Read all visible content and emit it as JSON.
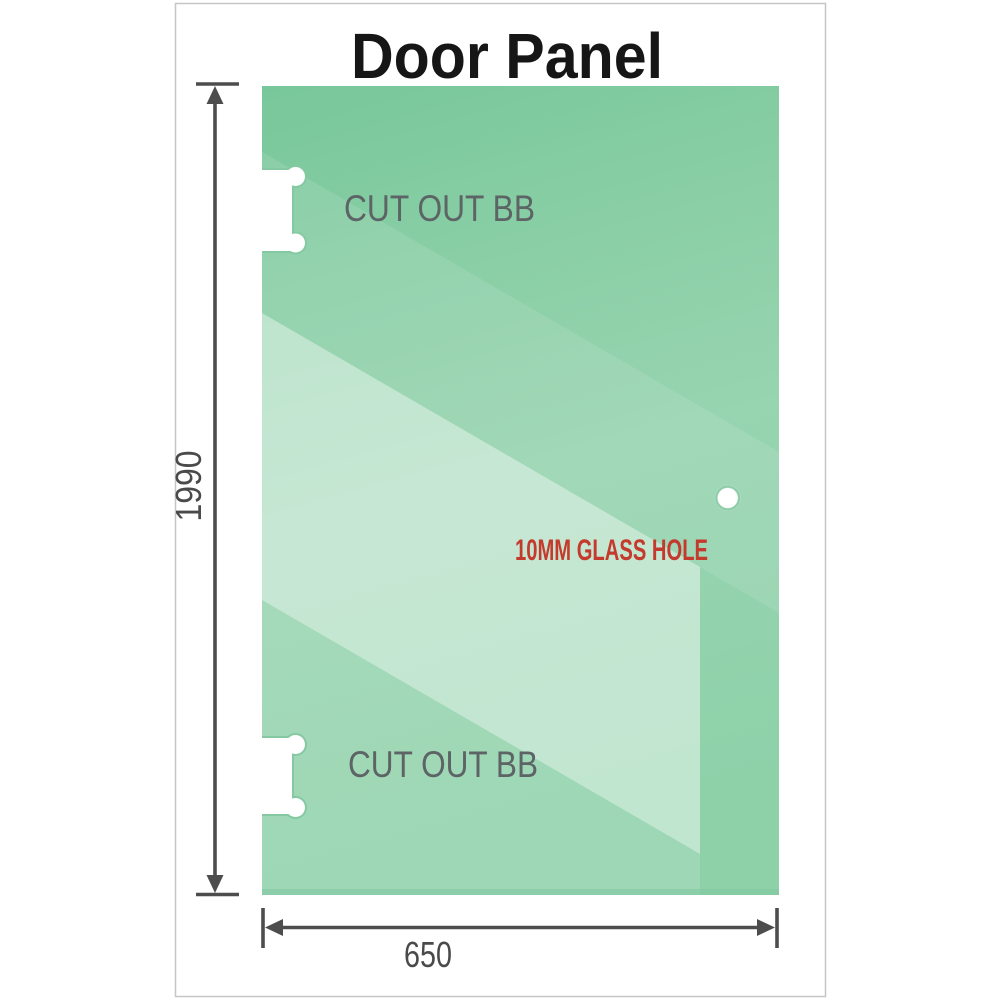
{
  "title": "Door Panel",
  "glass_panel": {
    "cutouts": [
      {
        "label": "CUT OUT BB"
      },
      {
        "label": "CUT OUT BB"
      }
    ],
    "hole": {
      "label": "10MM GLASS HOLE"
    }
  },
  "dimensions": {
    "height": "1990",
    "width": "650"
  },
  "colors": {
    "glass_green": "#78c79b",
    "glass_highlight": "#c6e9d3",
    "glass_edge": "#84c9a2",
    "dimension_line": "#4d4d4d",
    "cutout_label_gray": "#5d6466",
    "hole_label_red": "#c43b2d",
    "title_black": "#161616",
    "frame_border": "#c6c6c6"
  }
}
